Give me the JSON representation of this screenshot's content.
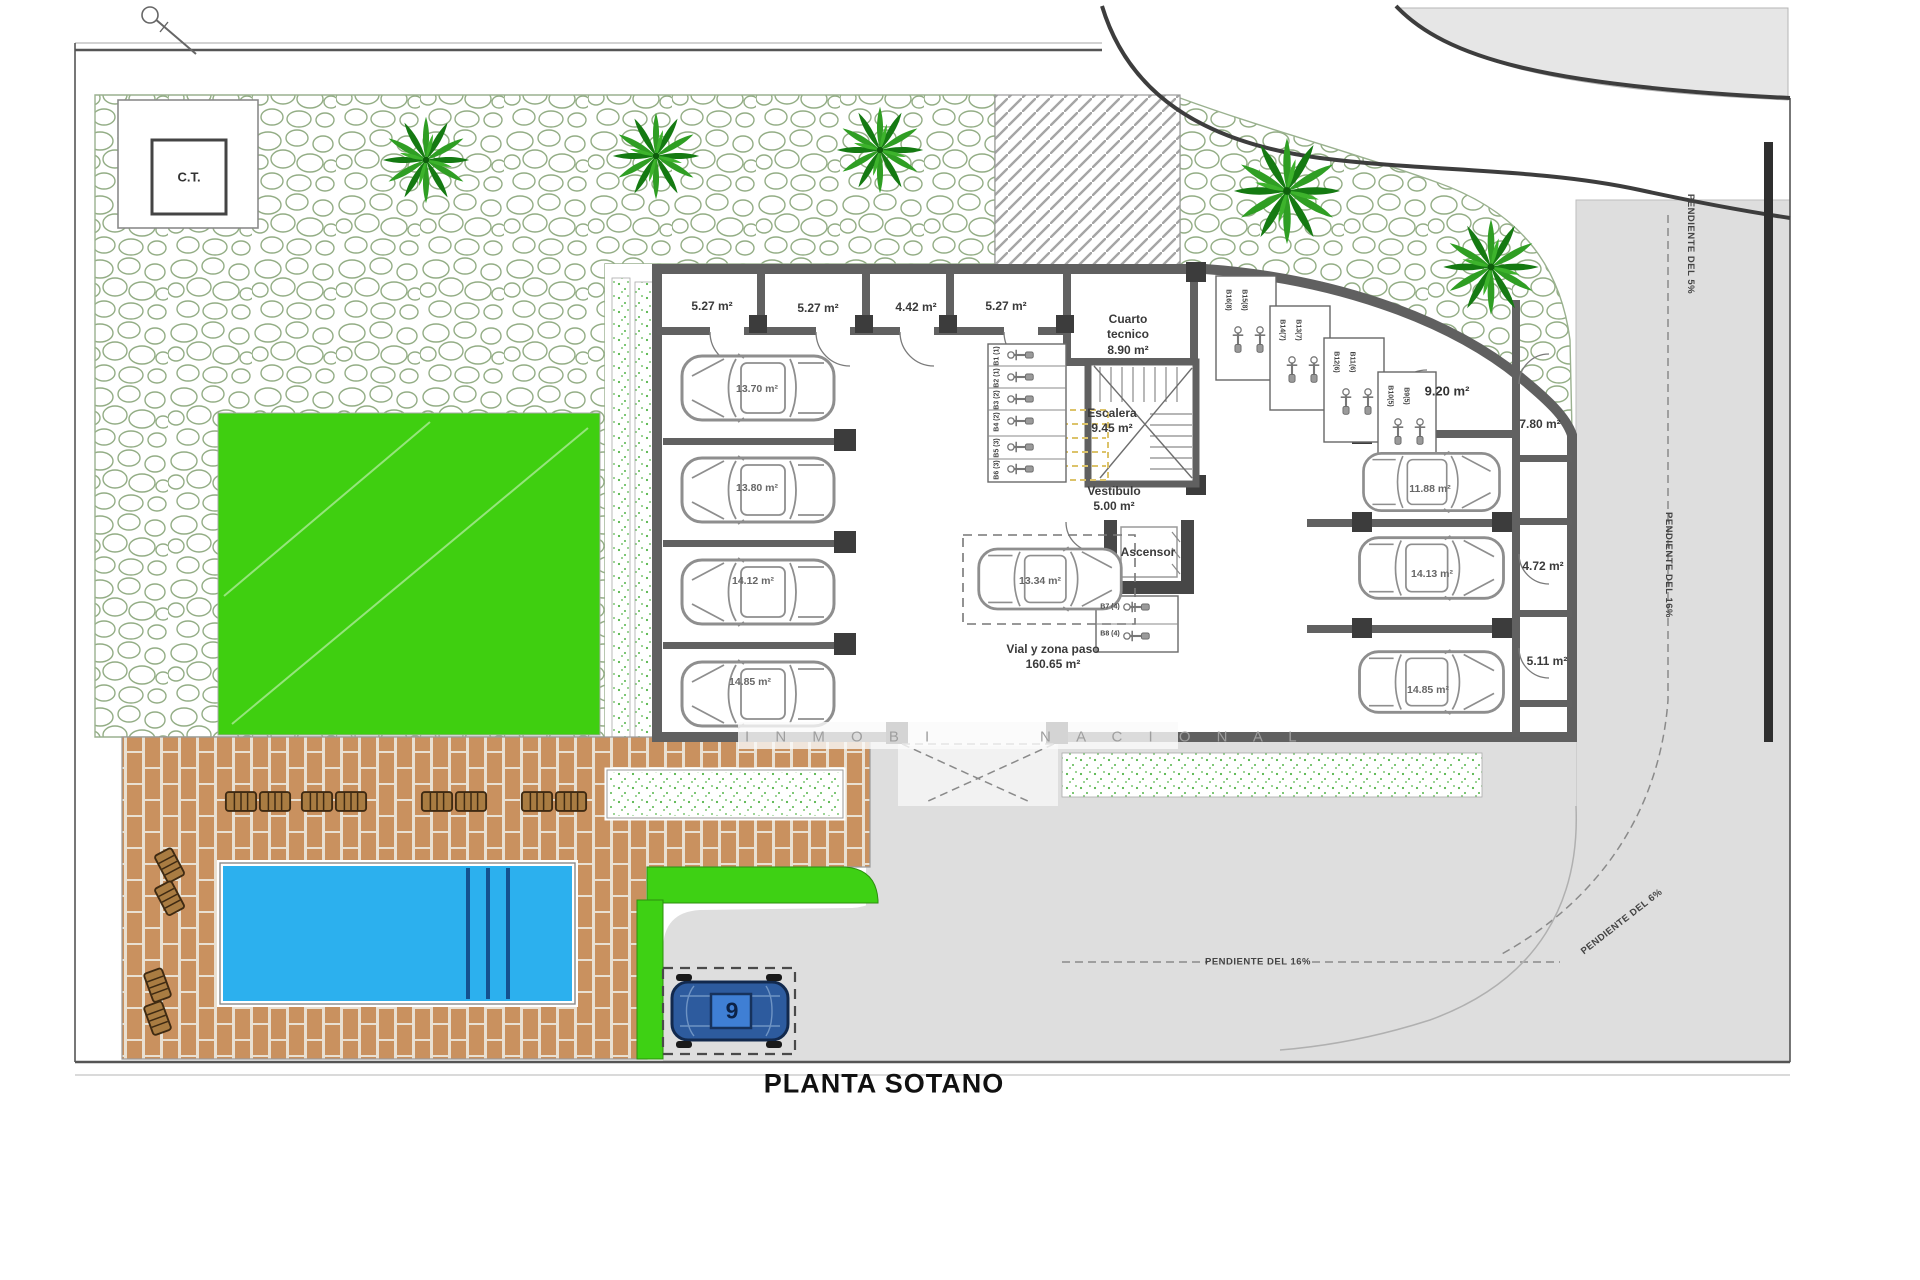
{
  "title": "PLANTA SOTANO",
  "transformer_box": "C.T.",
  "watermark": {
    "left": "I N M O B I",
    "right": "N A C I O N A L"
  },
  "rooms": {
    "storage": [
      "5.27 m²",
      "5.27 m²",
      "4.42 m²",
      "5.27 m²"
    ],
    "cuarto_tecnico": {
      "line1": "Cuarto",
      "line2": "tecnico",
      "area": "8.90 m²"
    },
    "escalera": {
      "name": "Escalera",
      "area": "9.45 m²"
    },
    "vestibulo": {
      "name": "Vestibulo",
      "area": "5.00 m²"
    },
    "ascensor": {
      "name": "Ascensor"
    },
    "vial": {
      "name": "Vial y zona paso",
      "area": "160.65 m²"
    },
    "side": [
      "9.20 m²",
      "7.80 m²",
      "4.72 m²",
      "5.11 m²"
    ]
  },
  "parking": {
    "left": [
      "13.70 m²",
      "13.80 m²",
      "14.12 m²",
      "14.85 m²"
    ],
    "center": "13.34 m²",
    "right": [
      "11.88 m²",
      "14.13 m²",
      "14.85 m²"
    ],
    "entrance_space_number": "9"
  },
  "moto": {
    "left_column": [
      "B1 (1)",
      "B2 (1)",
      "B3 (2)",
      "B4 (2)",
      "B5 (3)",
      "B6 (3)"
    ],
    "below_lift": [
      "B7 (4)",
      "B8 (4)"
    ],
    "diagonal": [
      "B16(8)",
      "B15(8)",
      "B14(7)",
      "B13(7)",
      "B12(6)",
      "B11(6)",
      "B10(5)",
      "B9(5)"
    ]
  },
  "slopes": {
    "top_right": "PENDIENTE DEL 5%",
    "right": "PENDIENTE DEL 16%",
    "curve": "PENDIENTE DEL 6%",
    "bottom": "PENDIENTE DEL 16%"
  },
  "colors": {
    "lawn": "#3fcf10",
    "green_strip": "#3ed114",
    "pool": "#2cb0ee",
    "brick": "#c9915f",
    "road": "#dedede",
    "wall": "#606060",
    "tree": "#2f9e23",
    "stair_dash": "#dcc36a"
  }
}
